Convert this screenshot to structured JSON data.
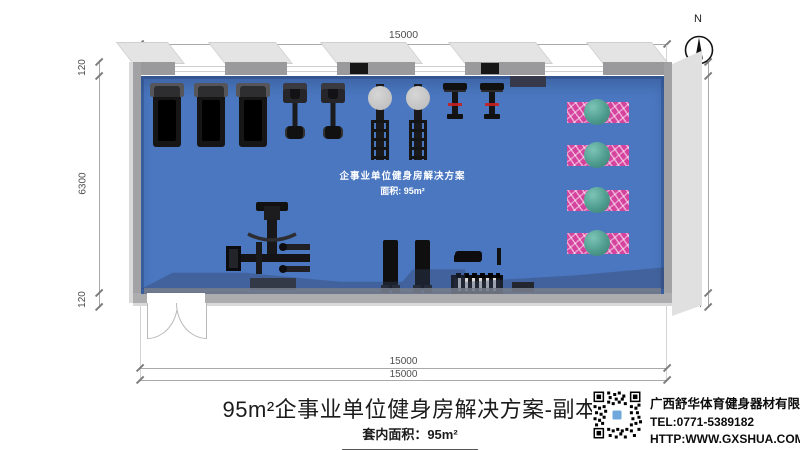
{
  "compass": {
    "label": "N"
  },
  "dimensions": {
    "top": "15000",
    "bottom_inner": "15000",
    "bottom_outer": "15000",
    "left": [
      "120",
      "6300",
      "120"
    ],
    "right": [
      "120",
      "6300",
      "120"
    ]
  },
  "room": {
    "label_line1": "企事业单位健身房解决方案",
    "label_line2": "面积: 95m²",
    "floor_color": "#4a77c0",
    "mat_color": "#d6439e",
    "ball_color": "#4b998c"
  },
  "equipment": {
    "treadmill_count": 3,
    "upright_bike_count": 2,
    "elliptical_count": 2,
    "spin_bike_count": 2,
    "yoga_mat_with_ball_count": 4,
    "cable_station_count": 1,
    "vertical_bench_count": 2,
    "flat_bench_count": 1,
    "dumbbell_rack_count": 1
  },
  "title_block": {
    "title": "95m²企事业单位健身房解决方案-副本",
    "subtitle": "套内面积：95m²"
  },
  "company": {
    "name": "广西舒华体育健身器材有限公司",
    "tel": "TEL:0771-5389182",
    "url": "HTTP:WWW.GXSHUA.COM"
  }
}
